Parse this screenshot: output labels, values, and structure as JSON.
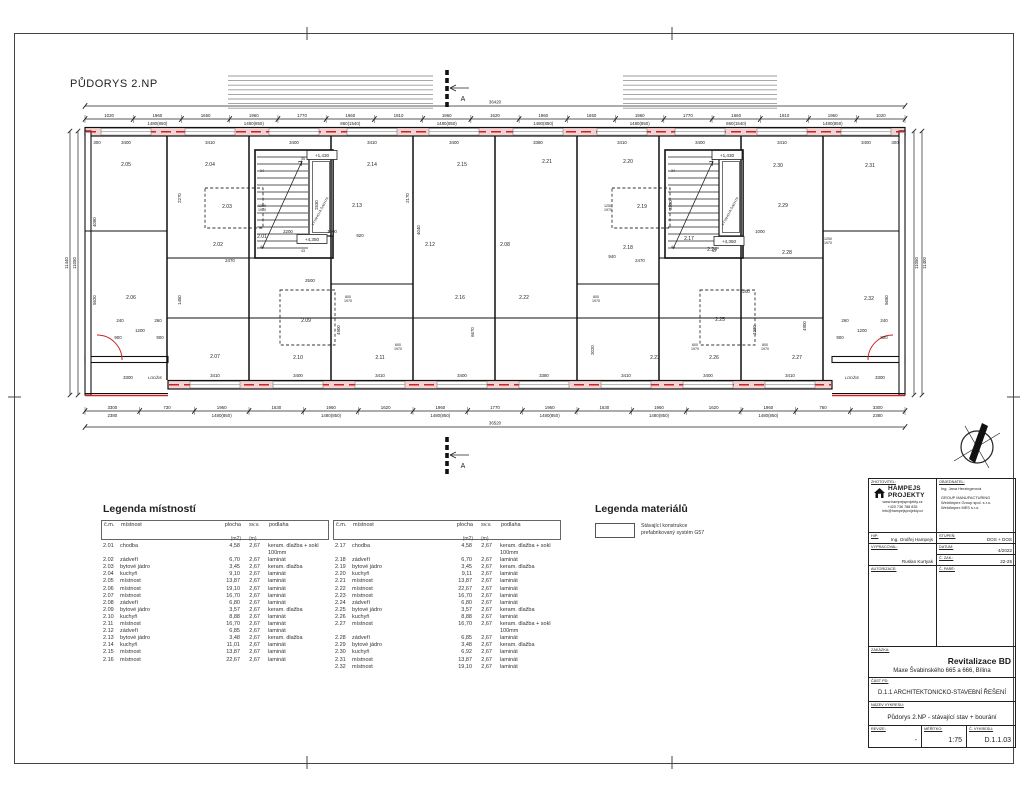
{
  "sheet": {
    "title": "PŮDORYS 2.NP"
  },
  "plan": {
    "overall_dims": {
      "top": "36420",
      "bottom": "36520",
      "left_outer": "11440",
      "left_inner": "11050",
      "right_inner": "11050",
      "right_outer": "11400"
    },
    "section_label": "A",
    "loggia_left": {
      "label": "LODŽIE",
      "dim": "3300"
    },
    "loggia_right": {
      "label": "LODŽIE",
      "dim": "3300"
    },
    "elevator_label": "VÝTAHOVÁ ŠACHTA",
    "level_markers": [
      {
        "text": "+1,430",
        "x": 322,
        "y": 157
      },
      {
        "text": "+1,430",
        "x": 727,
        "y": 157
      },
      {
        "text": "+4,350",
        "x": 312,
        "y": 241
      },
      {
        "text": "+4,350",
        "x": 729,
        "y": 243
      }
    ],
    "rooms": [
      {
        "n": "2.05",
        "x": 126,
        "y": 166
      },
      {
        "n": "2.04",
        "x": 210,
        "y": 166
      },
      {
        "n": "2.14",
        "x": 372,
        "y": 166
      },
      {
        "n": "2.15",
        "x": 462,
        "y": 166
      },
      {
        "n": "2.21",
        "x": 547,
        "y": 163
      },
      {
        "n": "2.20",
        "x": 628,
        "y": 163
      },
      {
        "n": "2.30",
        "x": 778,
        "y": 167
      },
      {
        "n": "2.31",
        "x": 870,
        "y": 167
      },
      {
        "n": "2.03",
        "x": 227,
        "y": 208
      },
      {
        "n": "2.13",
        "x": 357,
        "y": 207
      },
      {
        "n": "2.19",
        "x": 642,
        "y": 208
      },
      {
        "n": "2.29",
        "x": 783,
        "y": 207
      },
      {
        "n": "2.02",
        "x": 218,
        "y": 246
      },
      {
        "n": "2.01",
        "x": 262,
        "y": 238
      },
      {
        "n": "2.12",
        "x": 430,
        "y": 246
      },
      {
        "n": "2.08",
        "x": 505,
        "y": 246
      },
      {
        "n": "2.18",
        "x": 628,
        "y": 249
      },
      {
        "n": "2.17",
        "x": 689,
        "y": 240
      },
      {
        "n": "2.24",
        "x": 712,
        "y": 251
      },
      {
        "n": "2.28",
        "x": 787,
        "y": 254
      },
      {
        "n": "2.06",
        "x": 131,
        "y": 299
      },
      {
        "n": "2.09",
        "x": 306,
        "y": 322
      },
      {
        "n": "2.16",
        "x": 460,
        "y": 299
      },
      {
        "n": "2.22",
        "x": 524,
        "y": 299
      },
      {
        "n": "2.25",
        "x": 720,
        "y": 321
      },
      {
        "n": "2.32",
        "x": 869,
        "y": 300
      },
      {
        "n": "2.07",
        "x": 215,
        "y": 358
      },
      {
        "n": "2.10",
        "x": 298,
        "y": 359
      },
      {
        "n": "2.11",
        "x": 380,
        "y": 359
      },
      {
        "n": "2.23",
        "x": 655,
        "y": 359
      },
      {
        "n": "2.26",
        "x": 714,
        "y": 359
      },
      {
        "n": "2.27",
        "x": 797,
        "y": 359
      }
    ],
    "top_chain_row1": [
      "1020",
      "1960",
      "1650",
      "1960",
      "1770",
      "1660",
      "1810",
      "1960",
      "1620",
      "1960",
      "1650",
      "1960",
      "1770",
      "1660",
      "1810",
      "1960",
      "1020"
    ],
    "top_chain_row2": [
      "",
      "1480(850)",
      "",
      "1480(850)",
      "",
      "860(1540)",
      "",
      "1480(850)",
      "",
      "1480(850)",
      "",
      "1480(850)",
      "",
      "860(1540)",
      "",
      "1480(850)",
      ""
    ],
    "bottom_chain_row1": [
      "3300",
      "730",
      "1960",
      "1630",
      "1960",
      "1620",
      "1960",
      "1770",
      "1960",
      "1630",
      "1960",
      "1620",
      "1960",
      "760",
      "3300"
    ],
    "bottom_chain_row2": [
      "2380",
      "",
      "1480(850)",
      "",
      "1480(850)",
      "",
      "1480(850)",
      "",
      "1480(850)",
      "",
      "1480(850)",
      "",
      "1480(850)",
      "",
      "2380"
    ],
    "module_dims_top": [
      {
        "t": "300",
        "x": 97
      },
      {
        "t": "3400",
        "x": 126
      },
      {
        "t": "3410",
        "x": 210
      },
      {
        "t": "3400",
        "x": 294
      },
      {
        "t": "3410",
        "x": 372
      },
      {
        "t": "3400",
        "x": 454
      },
      {
        "t": "3380",
        "x": 538
      },
      {
        "t": "3410",
        "x": 622
      },
      {
        "t": "3400",
        "x": 700
      },
      {
        "t": "3410",
        "x": 782
      },
      {
        "t": "3400",
        "x": 866
      },
      {
        "t": "300",
        "x": 895
      }
    ],
    "module_dims_bottom": [
      {
        "t": "3410",
        "x": 215
      },
      {
        "t": "3400",
        "x": 298
      },
      {
        "t": "3410",
        "x": 380
      },
      {
        "t": "3400",
        "x": 462
      },
      {
        "t": "3380",
        "x": 544
      },
      {
        "t": "3410",
        "x": 626
      },
      {
        "t": "3400",
        "x": 708
      },
      {
        "t": "3410",
        "x": 790
      }
    ],
    "v_dims": [
      {
        "t": "4080",
        "x": 96,
        "y": 222
      },
      {
        "t": "5620",
        "x": 96,
        "y": 300
      },
      {
        "t": "2270",
        "x": 181,
        "y": 198
      },
      {
        "t": "1450",
        "x": 181,
        "y": 300
      },
      {
        "t": "2170",
        "x": 409,
        "y": 198
      },
      {
        "t": "4040",
        "x": 420,
        "y": 230
      },
      {
        "t": "4900",
        "x": 340,
        "y": 330
      },
      {
        "t": "6670",
        "x": 474,
        "y": 332
      },
      {
        "t": "4900",
        "x": 806,
        "y": 326
      },
      {
        "t": "5650",
        "x": 888,
        "y": 300
      },
      {
        "t": "2530",
        "x": 318,
        "y": 205
      },
      {
        "t": "2530",
        "x": 672,
        "y": 205
      },
      {
        "t": "2020",
        "x": 594,
        "y": 350
      },
      {
        "t": "1230",
        "x": 756,
        "y": 330
      }
    ],
    "h_dims": [
      {
        "t": "2470",
        "x": 230,
        "y": 262
      },
      {
        "t": "2500",
        "x": 310,
        "y": 282
      },
      {
        "t": "2200",
        "x": 288,
        "y": 233
      },
      {
        "t": "1000",
        "x": 332,
        "y": 233
      },
      {
        "t": "920",
        "x": 360,
        "y": 237
      },
      {
        "t": "2470",
        "x": 640,
        "y": 262
      },
      {
        "t": "2200",
        "x": 745,
        "y": 293
      },
      {
        "t": "1000",
        "x": 760,
        "y": 233
      },
      {
        "t": "940",
        "x": 612,
        "y": 258
      },
      {
        "t": "240",
        "x": 120,
        "y": 322
      },
      {
        "t": "1200",
        "x": 140,
        "y": 332
      },
      {
        "t": "260",
        "x": 158,
        "y": 322
      },
      {
        "t": "900",
        "x": 118,
        "y": 339
      },
      {
        "t": "900",
        "x": 160,
        "y": 339
      },
      {
        "t": "260",
        "x": 845,
        "y": 322
      },
      {
        "t": "1200",
        "x": 862,
        "y": 332
      },
      {
        "t": "240",
        "x": 884,
        "y": 322
      },
      {
        "t": "900",
        "x": 840,
        "y": 339
      },
      {
        "t": "800",
        "x": 884,
        "y": 339
      }
    ],
    "window_pairs": [
      {
        "t": "1250|1970",
        "x": 262,
        "y": 207
      },
      {
        "t": "1250|1970",
        "x": 608,
        "y": 207
      },
      {
        "t": "1250|1970",
        "x": 828,
        "y": 240
      },
      {
        "t": "800|1970",
        "x": 348,
        "y": 298
      },
      {
        "t": "800|1970",
        "x": 596,
        "y": 298
      },
      {
        "t": "600|1970",
        "x": 695,
        "y": 346
      },
      {
        "t": "800|1970",
        "x": 765,
        "y": 346
      },
      {
        "t": "600|1970",
        "x": 398,
        "y": 346
      }
    ],
    "stair_nums": [
      {
        "t": "34",
        "x": 262,
        "y": 172
      },
      {
        "t": "35",
        "x": 303,
        "y": 160
      },
      {
        "t": "44",
        "x": 262,
        "y": 248
      },
      {
        "t": "43",
        "x": 303,
        "y": 252
      },
      {
        "t": "34",
        "x": 673,
        "y": 172
      },
      {
        "t": "35",
        "x": 714,
        "y": 160
      },
      {
        "t": "44",
        "x": 673,
        "y": 248
      },
      {
        "t": "43",
        "x": 714,
        "y": 252
      }
    ]
  },
  "legend_rooms": {
    "title": "Legenda místností",
    "headers": {
      "cm": "č.m.",
      "mistnost": "místnost",
      "plocha": "plocha",
      "plocha_u": "(m2)",
      "svv": "sv.v.",
      "svv_u": "(m)",
      "podlaha": "podlaha"
    },
    "table1": [
      [
        "2.01",
        "chodba",
        "4,58",
        "2,67",
        "keram. dlažba + sokl 100mm"
      ],
      [
        "2.02",
        "zádveří",
        "6,70",
        "2,67",
        "laminát"
      ],
      [
        "2.03",
        "bytové jádro",
        "3,45",
        "2,67",
        "keram. dlažba"
      ],
      [
        "2.04",
        "kuchyň",
        "9,10",
        "2,67",
        "laminát"
      ],
      [
        "2.05",
        "místnost",
        "13,87",
        "2,67",
        "laminát"
      ],
      [
        "2.06",
        "místnost",
        "19,10",
        "2,67",
        "laminát"
      ],
      [
        "2.07",
        "místnost",
        "16,70",
        "2,67",
        "laminát"
      ],
      [
        "2.08",
        "zádveří",
        "6,80",
        "2,67",
        "laminát"
      ],
      [
        "2.09",
        "bytové jádro",
        "3,57",
        "2,67",
        "keram. dlažba"
      ],
      [
        "2.10",
        "kuchyň",
        "8,88",
        "2,67",
        "laminát"
      ],
      [
        "2.11",
        "místnost",
        "16,70",
        "2,67",
        "laminát"
      ],
      [
        "2.12",
        "zádveří",
        "6,85",
        "2,67",
        "laminát"
      ],
      [
        "2.13",
        "bytové jádro",
        "3,48",
        "2,67",
        "keram. dlažba"
      ],
      [
        "2.14",
        "kuchyň",
        "11,01",
        "2,67",
        "laminát"
      ],
      [
        "2.15",
        "místnost",
        "13,87",
        "2,67",
        "laminát"
      ],
      [
        "2.16",
        "místnost",
        "22,67",
        "2,67",
        "laminát"
      ]
    ],
    "table2": [
      [
        "2.17",
        "chodba",
        "4,58",
        "2,67",
        "keram. dlažba + sokl 100mm"
      ],
      [
        "2.18",
        "zádveří",
        "6,70",
        "2,67",
        "laminát"
      ],
      [
        "2.19",
        "bytové jádro",
        "3,45",
        "2,67",
        "keram. dlažba"
      ],
      [
        "2.20",
        "kuchyň",
        "9,11",
        "2,67",
        "laminát"
      ],
      [
        "2.21",
        "místnost",
        "13,87",
        "2,67",
        "laminát"
      ],
      [
        "2.22",
        "místnost",
        "22,67",
        "2,67",
        "laminát"
      ],
      [
        "2.23",
        "místnost",
        "16,70",
        "2,67",
        "laminát"
      ],
      [
        "2.24",
        "zádveří",
        "6,80",
        "2,67",
        "laminát"
      ],
      [
        "2.25",
        "bytové jádro",
        "3,57",
        "2,67",
        "keram. dlažba"
      ],
      [
        "2.26",
        "kuchyň",
        "8,88",
        "2,67",
        "laminát"
      ],
      [
        "2.27",
        "místnost",
        "16,70",
        "2,67",
        "keram. dlažba + sokl 100mm"
      ],
      [
        "2.28",
        "zádveří",
        "6,85",
        "2,67",
        "laminát"
      ],
      [
        "2.29",
        "bytové jádro",
        "3,48",
        "2,67",
        "keram. dlažba"
      ],
      [
        "2.30",
        "kuchyň",
        "6,92",
        "2,67",
        "laminát"
      ],
      [
        "2.31",
        "místnost",
        "13,87",
        "2,67",
        "laminát"
      ],
      [
        "2.32",
        "místnost",
        "19,10",
        "2,67",
        "laminát"
      ]
    ]
  },
  "legend_materials": {
    "title": "Legenda materiálů",
    "item_line1": "Stávající konstrukce",
    "item_line2": "prefabrikovaný systém G57"
  },
  "titleblock": {
    "zhotovitel_label": "ZHOTOVITEL:",
    "logo_line1": "HAMPEJS",
    "logo_line2": "PROJEKTY",
    "contact1": "www.hampejsprojekty.cz",
    "contact2": "+420 736 788 835",
    "contact3": "info@hampejsprojekty.cz",
    "objednatel_label": "OBJEDNATEL:",
    "client1": "Ing. Jana Herzingerová",
    "client2": "GROUP MANUFACTURING",
    "client3": "WeldImpex Group spol. s.r.o.",
    "client4": "WeldImpex MES s.r.o.",
    "hip_label": "HIP:",
    "hip": "Ing. Ondřej Hampejs",
    "vypracoval_label": "VYPRACOVAL:",
    "vypracoval": "Ruslan Kurtyak",
    "stupen_label": "STUPEŇ:",
    "stupen": "DOS + DOS",
    "datum_label": "DATUM:",
    "datum": "4/2022",
    "czak_label": "Č. ZAK.:",
    "czak": "22-25",
    "autorizace_label": "AUTORIZACE:",
    "cpare_label": "Č. PARÉ:",
    "zakazka_label": "ZAKÁZKA:",
    "project": "Revitalizace BD",
    "address": "Maxe Švabinského 665 a 666, Bílina",
    "cast_label": "ČÁST PD:",
    "cast": "D.1.1 ARCHITEKTONICKO-STAVEBNÍ ŘEŠENÍ",
    "nazev_label": "NÁZEV VÝKRESU:",
    "nazev": "Půdorys 2.NP - stávající stav + bourání",
    "revize_label": "REVIZE:",
    "revize": "-",
    "meritko_label": "MĚŘÍTKO:",
    "meritko": "1:75",
    "cvykresu_label": "Č. VÝKRESU:",
    "cvykresu": "D.1.1.03"
  }
}
